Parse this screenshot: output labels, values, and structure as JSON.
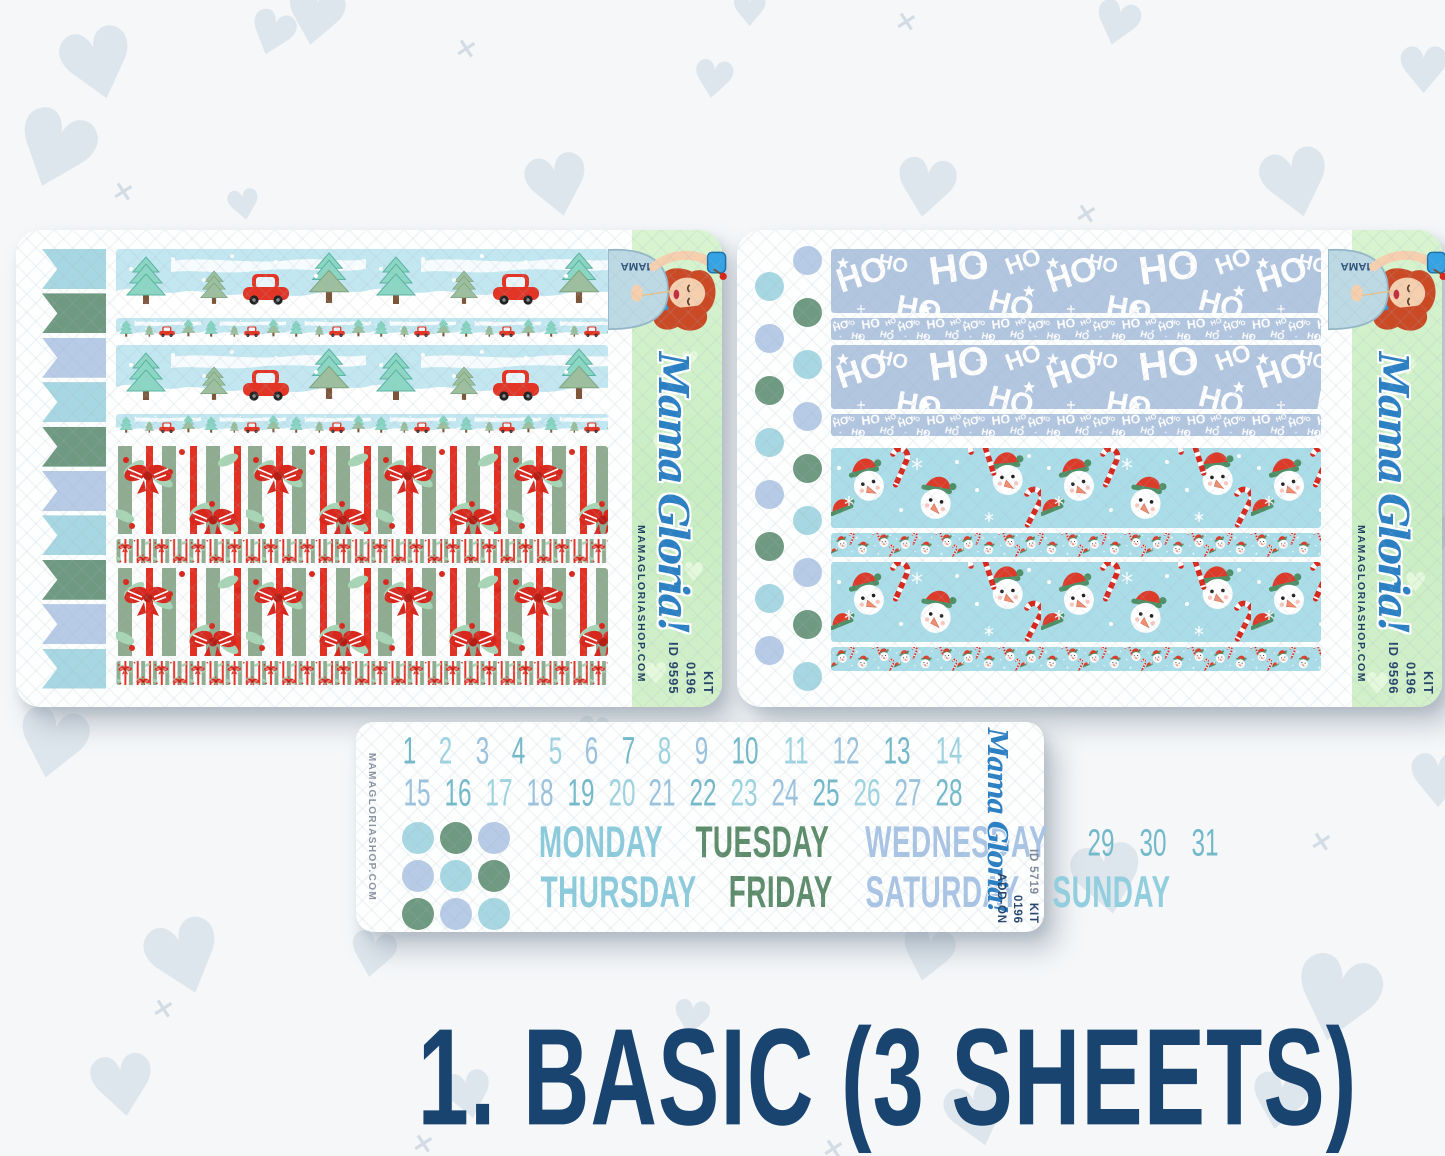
{
  "caption": "1. BASIC (3 SHEETS)",
  "brand": {
    "script": "Mama Gloria!",
    "url": "MAMAGLORIASHOP.COM",
    "shirt_text": "MAMA"
  },
  "sheet_left": {
    "name": "basic-kit-sheet-1",
    "kit_label": "KIT",
    "kit_number": "0196",
    "id": "ID 9595",
    "flag_count": 10,
    "flag_colors": [
      "#a7d7e2",
      "#6f9a81",
      "#b7cbe7"
    ],
    "washi_names": [
      "winter-trees-red-cars",
      "christmas-bows-stripes"
    ]
  },
  "sheet_right": {
    "name": "basic-kit-sheet-2",
    "kit_label": "KIT",
    "kit_number": "0196",
    "id": "ID 9596",
    "dot_count": 17,
    "dot_colors": [
      "#b7cbe7",
      "#a7d7e2",
      "#6f9a81"
    ],
    "washi_names": [
      "ho-ho-ho-script",
      "snowmen-candy-canes"
    ],
    "ho_text": "HO"
  },
  "sheet_addon": {
    "name": "date-cover-add-on-sheet",
    "id": "ID 5719",
    "kit_label": "KIT",
    "kit_number": "0196",
    "addon_label": "ADD-ON",
    "dates": [
      "1",
      "2",
      "3",
      "4",
      "5",
      "6",
      "7",
      "8",
      "9",
      "10",
      "11",
      "12",
      "13",
      "14",
      "15",
      "16",
      "17",
      "18",
      "19",
      "20",
      "21",
      "22",
      "23",
      "24",
      "25",
      "26",
      "27",
      "28",
      "29",
      "30",
      "31"
    ],
    "date_colors": [
      "#74b9c9",
      "#9ed3e0",
      "#9cc3dd"
    ],
    "days_row1": [
      {
        "label": "MONDAY",
        "color": "#8ccbdc"
      },
      {
        "label": "TUESDAY",
        "color": "#5d8c6b"
      },
      {
        "label": "WEDNESDAY",
        "color": "#a9c4e4"
      }
    ],
    "days_row2": [
      {
        "label": "THURSDAY",
        "color": "#8ccbdc"
      },
      {
        "label": "FRIDAY",
        "color": "#5d8c6b"
      },
      {
        "label": "SATURDAY",
        "color": "#a9c4e4"
      },
      {
        "label": "SUNDAY",
        "color": "#93cede"
      }
    ],
    "grid_dot_colors": [
      [
        "#a7d7e2",
        "#6f9a81",
        "#b7cbe7"
      ],
      [
        "#b7cbe7",
        "#a7d7e2",
        "#6f9a81"
      ],
      [
        "#6f9a81",
        "#b7cbe7",
        "#a7d7e2"
      ]
    ]
  },
  "colors": {
    "accent_blue": "#2b7fc3",
    "navy": "#27456b",
    "title_navy": "#1a4470",
    "brand_strip_green": "#cfeec6",
    "washi_sky_blue": "#c3e7f1",
    "washi_periwinkle": "#b3c6e0",
    "washi_snow_teal": "#abdde9",
    "washi_red": "#d8271c"
  }
}
